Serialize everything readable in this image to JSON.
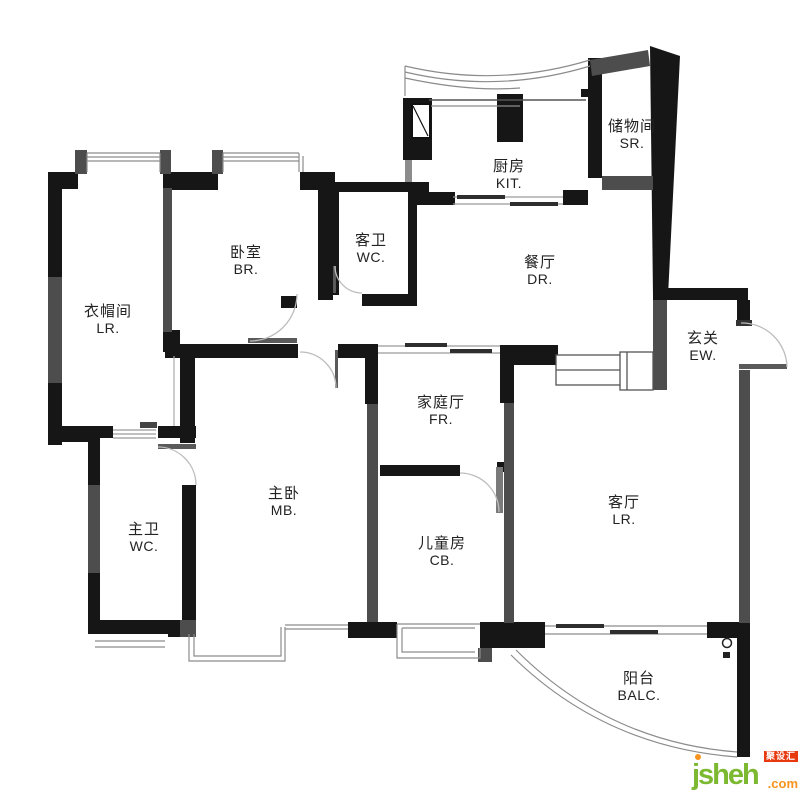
{
  "rooms": [
    {
      "zh": "厨房",
      "en": "KIT."
    },
    {
      "zh": "储物间",
      "en": "SR."
    },
    {
      "zh": "卧室",
      "en": "BR."
    },
    {
      "zh": "客卫",
      "en": "WC."
    },
    {
      "zh": "餐厅",
      "en": "DR."
    },
    {
      "zh": "衣帽间",
      "en": "LR."
    },
    {
      "zh": "玄关",
      "en": "EW."
    },
    {
      "zh": "家庭厅",
      "en": "FR."
    },
    {
      "zh": "主卧",
      "en": "MB."
    },
    {
      "zh": "主卫",
      "en": "WC."
    },
    {
      "zh": "儿童房",
      "en": "CB."
    },
    {
      "zh": "客厅",
      "en": "LR."
    },
    {
      "zh": "阳台",
      "en": "BALC."
    }
  ],
  "watermark": {
    "site": "jsheh",
    "tld": ".com",
    "badge": "聚设汇"
  },
  "colors": {
    "wall_main": "#161616",
    "wall_secondary": "#4d4d4d",
    "thin_line": "#8c8c8c",
    "door_arc": "#bdbdbd",
    "brand_green": "#7cb931",
    "brand_orange": "#f7941d",
    "brand_red": "#e8380d"
  }
}
